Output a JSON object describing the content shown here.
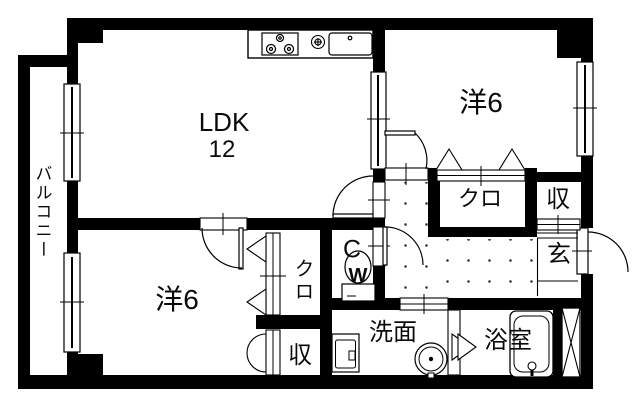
{
  "colors": {
    "background": "#ffffff",
    "line": "#000000"
  },
  "rooms": {
    "balcony": "バルコニー",
    "ldk": "LDK",
    "ldk_size": "12",
    "bedroom_top": "洋6",
    "bedroom_bottom": "洋6",
    "closet_top": "クロ",
    "closet_middle": "クロ",
    "storage_top": "収",
    "storage_bottom": "収",
    "entrance": "玄",
    "toilet_line1": "C",
    "toilet_line2": "W",
    "washroom": "洗面",
    "bathroom": "浴室"
  },
  "fixtures": [
    "stove-icon",
    "gas-ring-icon",
    "kitchen-sink-icon",
    "toilet-icon",
    "washbasin-icon",
    "washing-machine-icon",
    "bathtub-icon",
    "pipe-shaft-icon"
  ]
}
